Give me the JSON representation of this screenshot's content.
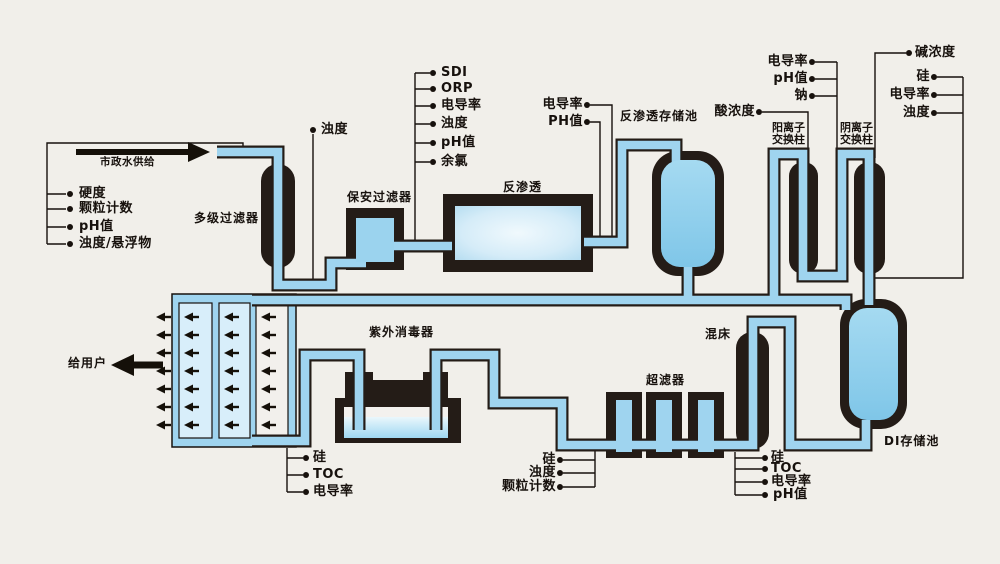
{
  "colors": {
    "background": "#f1efea",
    "pipe_blue": "#9fd4ef",
    "pale_channel_blue": "#d8eefa",
    "vessel_dark": "#241c17",
    "callout_black": "#17110d",
    "tank_fill_top": "#a5daf1",
    "tank_fill_bottom": "#7fc6e8"
  },
  "flow": {
    "supply": "市政水供给",
    "to_users": "给用户"
  },
  "feed_monitors": [
    "硬度",
    "颗粒计数",
    "pH值",
    "浊度/悬浮物"
  ],
  "turbidity_tap": "浊度",
  "equipment": {
    "multistage_filter": "多级过滤器",
    "security_filter": "保安过滤器",
    "ro": "反渗透",
    "ro_tank": "反渗透存储池",
    "cation_l1": "阳离子",
    "cation_l2": "交换柱",
    "anion_l1": "阴离子",
    "anion_l2": "交换柱",
    "uv": "紫外消毒器",
    "uf": "超滤器",
    "mixed_bed": "混床",
    "di_tank": "DI存储池"
  },
  "ro_feed_monitors": [
    "SDI",
    "ORP",
    "电导率",
    "浊度",
    "pH值",
    "余氯"
  ],
  "ro_out_monitors": [
    "电导率",
    "PH值"
  ],
  "dosing": {
    "acid": "酸浓度",
    "alkali": "碱浓度"
  },
  "cation_out_monitors": [
    "电导率",
    "pH值",
    "钠"
  ],
  "loop_supply_monitors": [
    "硅",
    "电导率",
    "浊度"
  ],
  "uv_out_monitors": [
    "硅",
    "TOC",
    "电导率"
  ],
  "uf_monitors": [
    "硅",
    "浊度",
    "颗粒计数"
  ],
  "mb_out_monitors": [
    "硅",
    "TOC",
    "电导率",
    "pH值"
  ]
}
